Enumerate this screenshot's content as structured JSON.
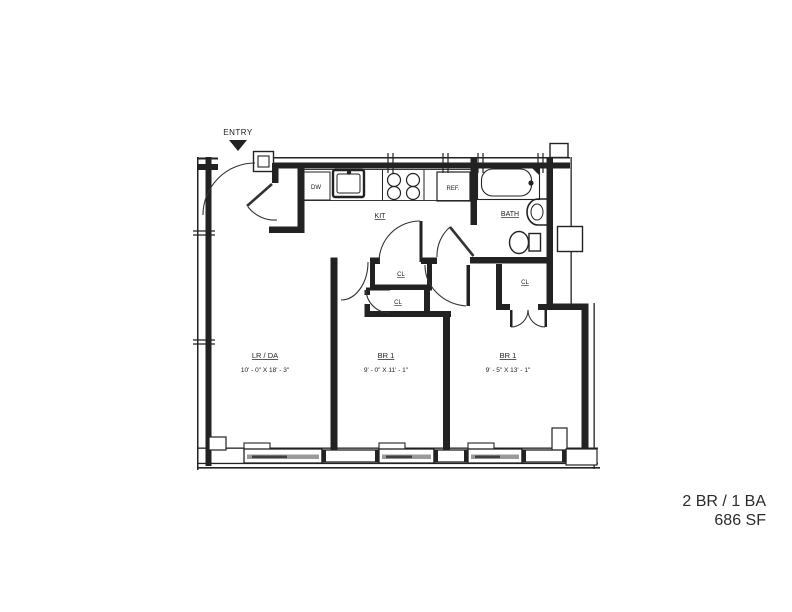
{
  "plan": {
    "entry_label": "ENTRY",
    "rooms": {
      "living": {
        "name": "LR / DA",
        "dims": "10' - 0\" X 18' - 3\""
      },
      "bedroom1": {
        "name": "BR 1",
        "dims": "9' - 0\" X 11' - 1\""
      },
      "bedroom2": {
        "name": "BR 1",
        "dims": "9' - 5\" X 13' - 1\""
      },
      "kitchen": {
        "name": "KIT"
      },
      "bath": {
        "name": "BATH"
      },
      "closet1": {
        "name": "CL"
      },
      "closet2": {
        "name": "CL"
      },
      "closet3": {
        "name": "CL"
      }
    },
    "appliances": {
      "dishwasher": "DW",
      "refrigerator": "REF."
    },
    "summary": {
      "line1": "2 BR / 1 BA",
      "line2": "686 SF"
    },
    "colors": {
      "line": "#222222",
      "window_band": "#9b9b9b",
      "window_core": "#404040",
      "background": "#ffffff"
    }
  }
}
